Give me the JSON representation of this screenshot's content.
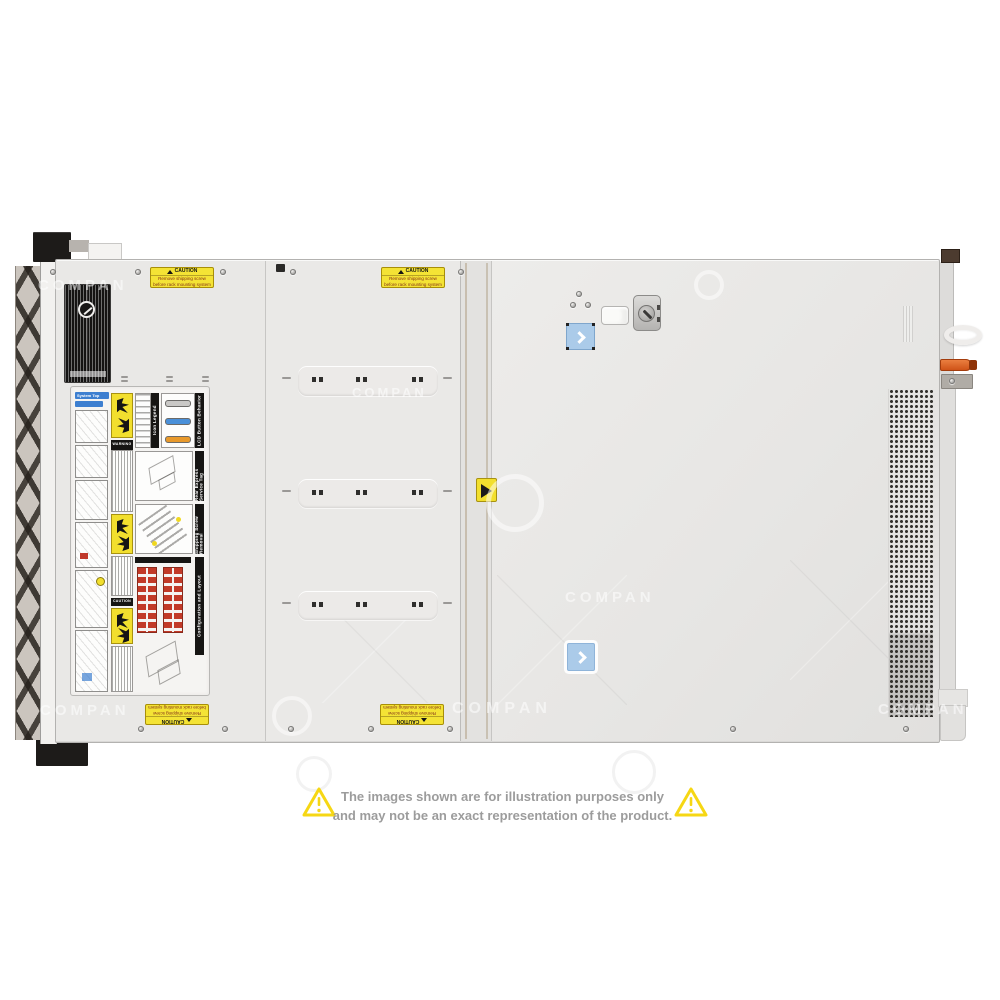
{
  "watermark": {
    "text": "COMPAN"
  },
  "disclaimer": {
    "line1": "The images shown are for illustration purposes only",
    "line2": "and may not be an exact representation of the product.",
    "text_color": "#9c9c9c",
    "triangle_color": "#f6d714"
  },
  "server": {
    "shipping_caution": {
      "title": "CAUTION",
      "line1": "Remove shipping screw",
      "line2": "before rack mounting system"
    },
    "service_panel": {
      "system_header": "System Top",
      "sections": [
        {
          "header": "Icon Legend"
        },
        {
          "header": "LCD Button Behavior"
        },
        {
          "header": "Rear Express Service Tag"
        },
        {
          "header": "Shipping Screw Removal"
        },
        {
          "header": "Configuration and Layout"
        }
      ],
      "warning_text": "WARNING",
      "caution_text": "CAUTION",
      "lcd_colors": {
        "ready": "#c9c8c6",
        "active": "#4a90d9",
        "alert": "#e8992b"
      },
      "drive_grid_color": "#c23a28"
    },
    "icons": {
      "cover_release": "chevron-right-icon",
      "hazard": "warning-triangle-icon",
      "keylock": "keylock-icon"
    },
    "accent_colors": {
      "release_lever_orange": "#d4591e",
      "latch_label_blue": "#abcbe9",
      "caution_yellow": "#f2df2e"
    }
  }
}
